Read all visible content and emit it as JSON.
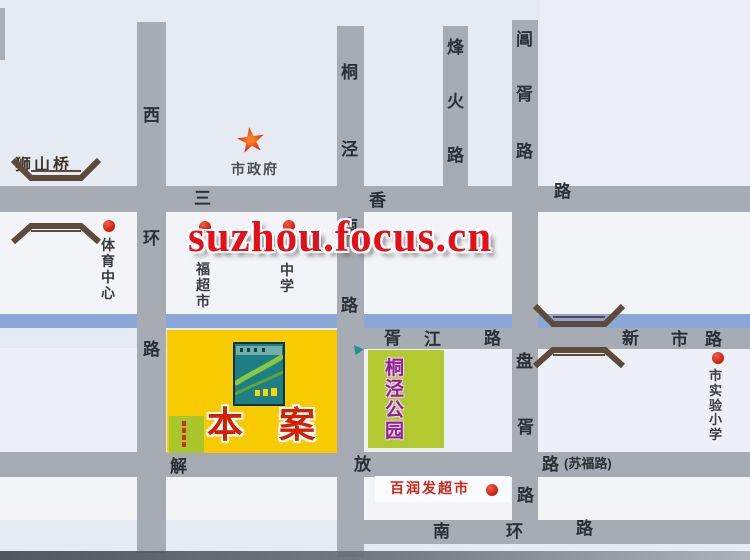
{
  "watermark": {
    "text": "suzhou.focus.cn"
  },
  "colors": {
    "road": "#a7acb4",
    "river": "#8ba6d8",
    "project_yellow": "#f8cb00",
    "park_green": "#b2c930",
    "accent_red": "#d7261a",
    "watermark_red": "#e60e18"
  },
  "roads": {
    "xihuan": {
      "chars": [
        "西",
        "环",
        "路"
      ]
    },
    "tongjing": {
      "chars": [
        "桐",
        "泾",
        "南",
        "路"
      ]
    },
    "fenghuo": {
      "chars": [
        "烽",
        "火",
        "路"
      ]
    },
    "changxu": {
      "chars": [
        "阊",
        "胥",
        "路"
      ]
    },
    "panxu": {
      "chars": [
        "盘",
        "胥",
        "路"
      ]
    },
    "sanxiang": {
      "chars": [
        "三",
        "香",
        "路"
      ]
    },
    "xujiang": {
      "chars": [
        "胥",
        "江",
        "路"
      ]
    },
    "xinshi": {
      "chars": [
        "新",
        "市",
        "路"
      ]
    },
    "jiefang": {
      "chars": [
        "解",
        "放",
        "路"
      ],
      "alt_name": "(苏福路)"
    },
    "nanhuan": {
      "chars": [
        "南",
        "环",
        "路"
      ]
    }
  },
  "pois": {
    "shishan_bridge": {
      "label": "狮山桥"
    },
    "city_government": {
      "label": "市政府"
    },
    "sports_center": {
      "label": "体育中心"
    },
    "fu_supermarket": {
      "label": "福超市"
    },
    "middle_school": {
      "label": "中学"
    },
    "rt_mart": {
      "label": "百润发超市"
    },
    "experimental_primary": {
      "label": "市实验小学"
    },
    "project": {
      "label": "本案"
    },
    "park": {
      "label": "桐泾公园"
    }
  }
}
